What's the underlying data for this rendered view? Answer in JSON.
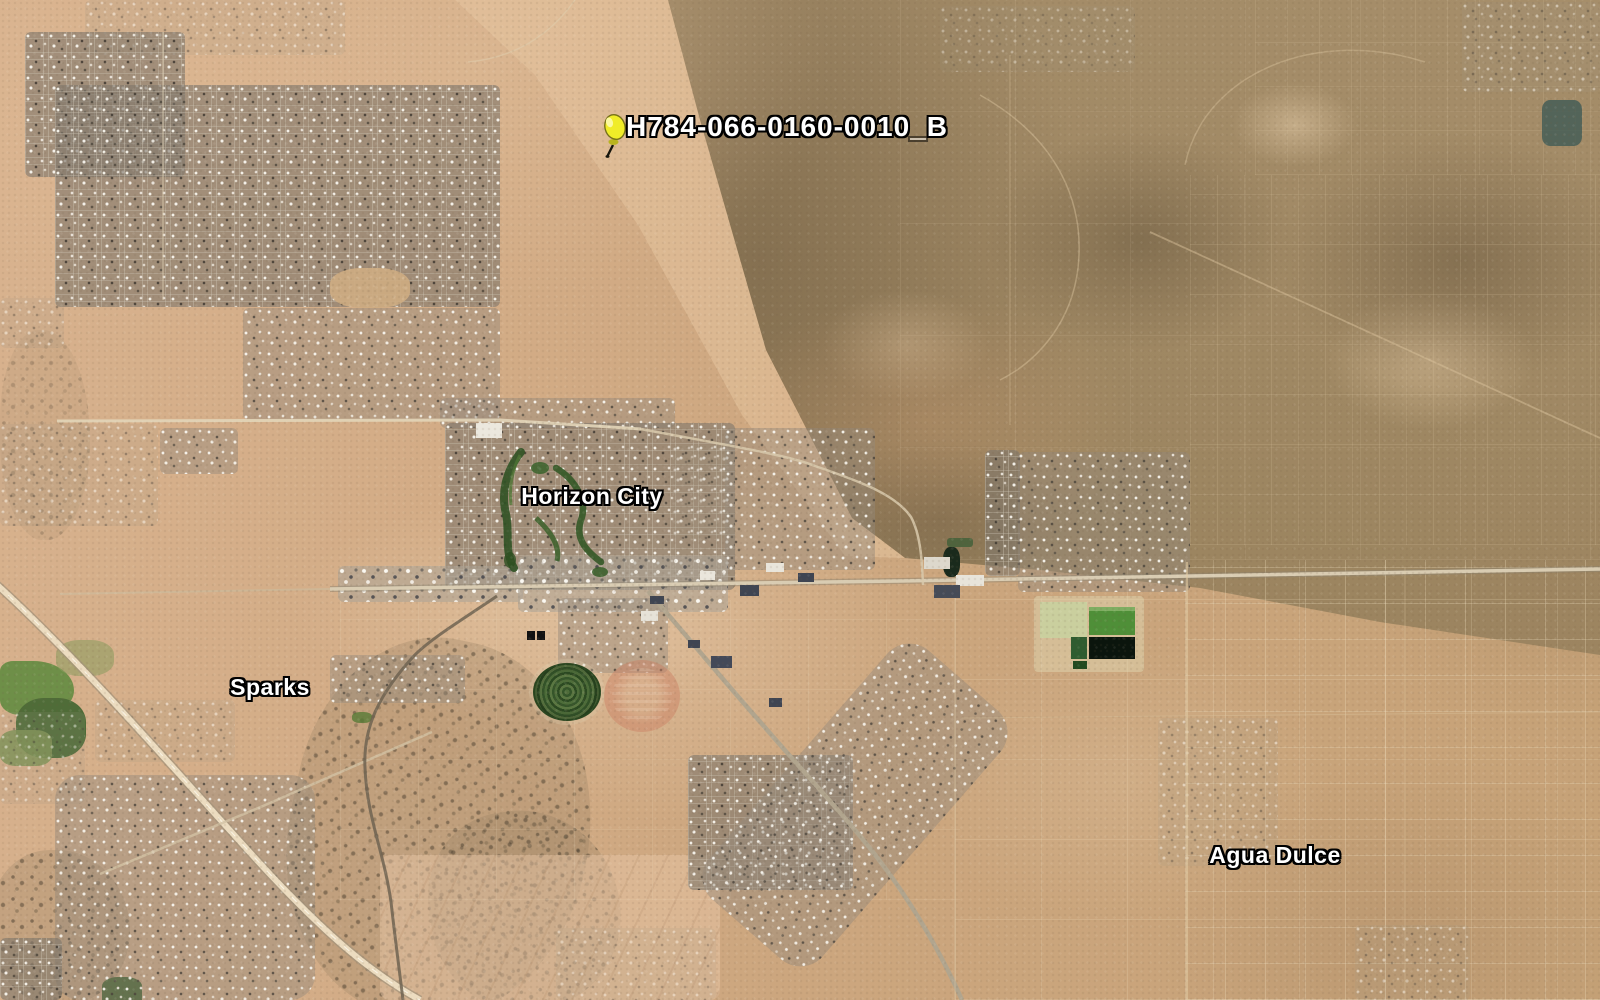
{
  "map": {
    "imagery": "satellite",
    "pin": {
      "label": "H784-066-0160-0010_B",
      "icon": "pushpin-icon",
      "color": "#f0ec28",
      "x": 614,
      "y": 130,
      "label_x": 626,
      "label_y": 113
    },
    "place_labels": [
      {
        "name": "Horizon City",
        "x": 592,
        "y": 496
      },
      {
        "name": "Sparks",
        "x": 270,
        "y": 687
      },
      {
        "name": "Agua Dulce",
        "x": 1275,
        "y": 855
      }
    ],
    "label_style": {
      "text_color": "#ffffff",
      "outline_color": "#000000"
    }
  }
}
